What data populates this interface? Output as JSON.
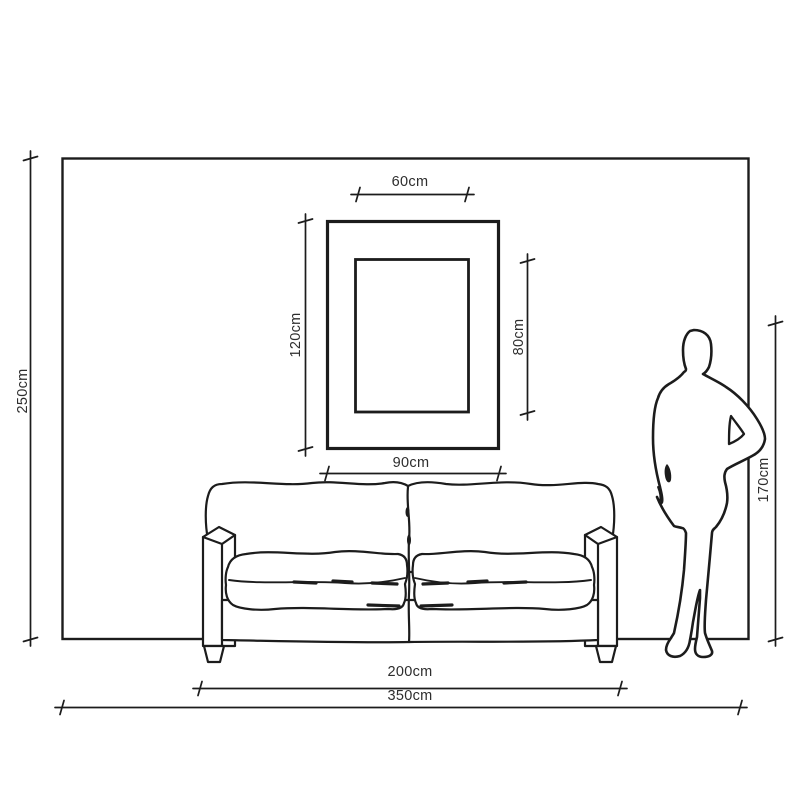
{
  "labels": {
    "frame_inner_width": "60cm",
    "frame_outer_height": "120cm",
    "frame_inner_height": "80cm",
    "frame_outer_width": "90cm",
    "wall_height": "250cm",
    "person_height": "170cm",
    "sofa_width": "200cm",
    "wall_width": "350cm"
  },
  "figures": {
    "wall": "wall-outline",
    "picture_frame": "picture-frame",
    "sofa": "two-seat-sofa-line-drawing",
    "person": "standing-woman-silhouette"
  },
  "colors": {
    "background": "#ffffff",
    "line": "#1c1c1c",
    "text": "#2d2d2d"
  }
}
